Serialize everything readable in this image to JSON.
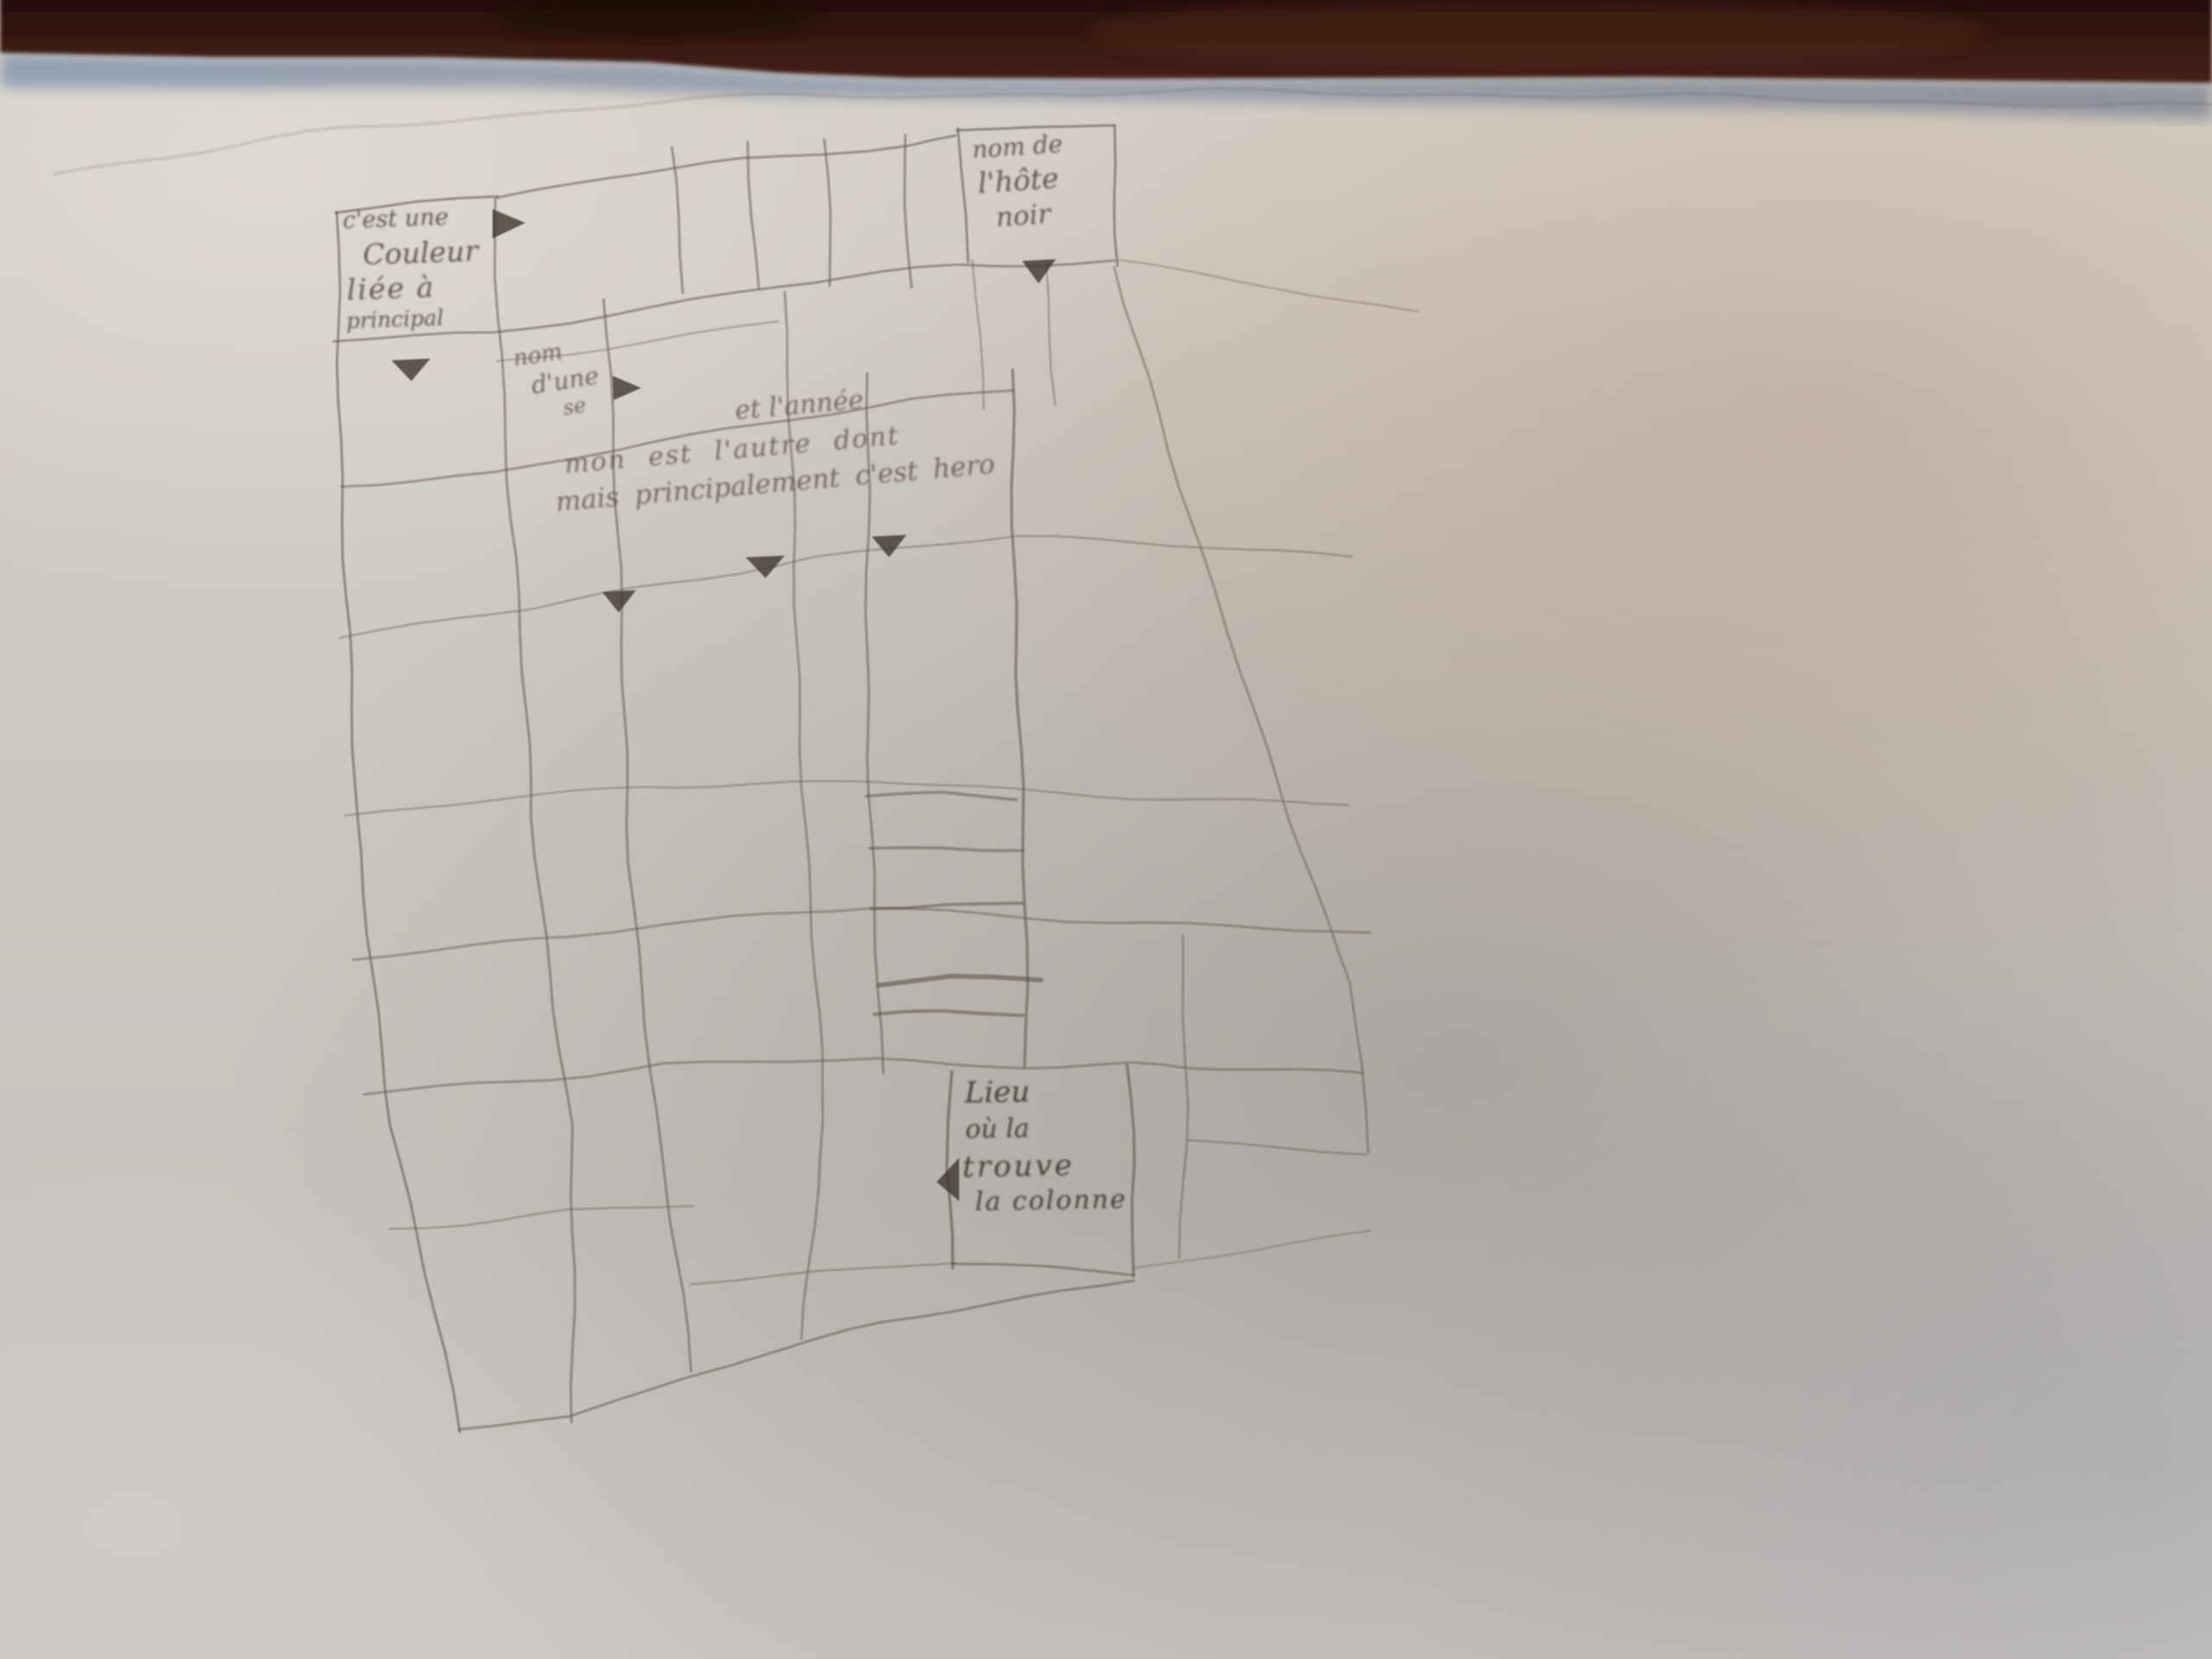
{
  "scene": {
    "description": "Photograph of a hand-drawn pencil table sketch on a white sheet of paper, dark red-brown table edge along the top",
    "colors": {
      "top_band": "#3a1a10",
      "top_band_highlight": "#5b2a1c",
      "band_shadow_strip": "#8495ab",
      "paper_light": "#d6d0c9",
      "paper_warm": "#baa28a",
      "paper_shadow": "#7e7874",
      "pencil": "#5f564b",
      "arrow_fill": "#3c342b"
    }
  },
  "annotations": {
    "top_left": {
      "lines": [
        "c'est une",
        "Couleur",
        "liée à",
        "principal"
      ]
    },
    "top_right": {
      "lines": [
        "nom de",
        "l'hôte",
        "noir"
      ]
    },
    "mid_left": {
      "lines": [
        "nom",
        "d'une",
        "se"
      ]
    },
    "middle": {
      "lines": [
        "et l'année",
        "mon est l'autre dont",
        "mais principalement c'est hero"
      ]
    },
    "bottom": {
      "lines": [
        "Lieu",
        "où la",
        "trouve",
        "la colonne"
      ]
    }
  },
  "arrows": [
    {
      "name": "arrow-right-top-left-cell",
      "direction": "right"
    },
    {
      "name": "arrow-down-top-right-cell",
      "direction": "down"
    },
    {
      "name": "arrow-down-first-column",
      "direction": "down"
    },
    {
      "name": "arrow-right-mid-left-note",
      "direction": "right"
    },
    {
      "name": "arrow-down-middle-left",
      "direction": "down"
    },
    {
      "name": "arrow-down-middle-center",
      "direction": "down"
    },
    {
      "name": "arrow-down-middle-right",
      "direction": "down"
    },
    {
      "name": "arrow-left-bottom-box",
      "direction": "left"
    }
  ]
}
